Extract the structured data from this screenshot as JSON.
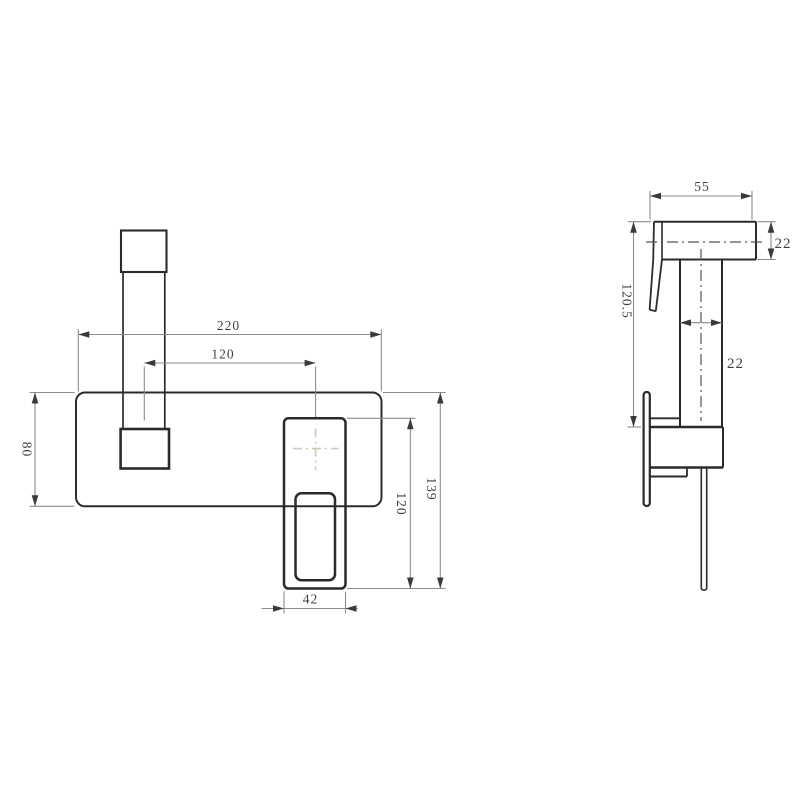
{
  "drawing": {
    "type": "technical-drawing",
    "subject": "wall-mounted square basin mixer faucet, front and side orthographic views with dimensions",
    "units": "mm",
    "colors": {
      "background": "#ffffff",
      "object_line": "#2b2b2b",
      "dimension_line": "#8c8c8c",
      "dimension_text": "#3f3f3f",
      "centerline": "#555555",
      "center_cross": "#cfc7b8"
    },
    "front_view": {
      "name": "front view",
      "dims": {
        "plate_width": "220",
        "spout_to_handle": "120",
        "plate_height": "80",
        "handle_plate_height": "120",
        "overall_height": "139",
        "handle_width": "42"
      }
    },
    "side_view": {
      "name": "side view",
      "dims": {
        "spout_reach": "55",
        "spout_section": "22",
        "drop_height": "120.5",
        "body_section": "22"
      }
    }
  }
}
